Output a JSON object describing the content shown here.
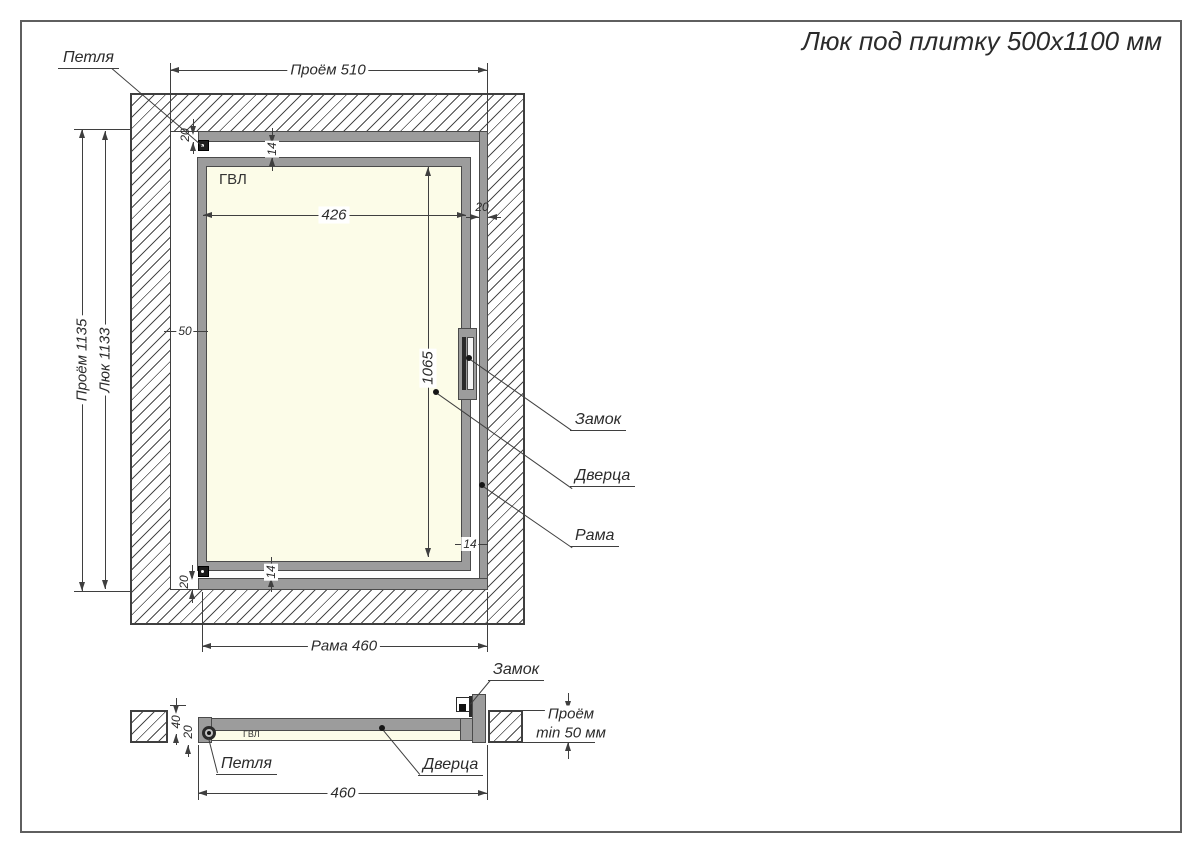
{
  "title": "Люк под плитку 500х1100 мм",
  "front_view": {
    "labels": {
      "hinge": "Петля",
      "lock": "Замок",
      "door": "Дверца",
      "frame": "Рама",
      "panel_material": "ГВЛ"
    },
    "dimensions": {
      "opening_width": "Проём 510",
      "opening_height": "Проём 1135",
      "hatch_height": "Люк 1133",
      "door_inner_width": "426",
      "door_inner_height": "1065",
      "side_offset": "50",
      "frame_top": "20",
      "gap_top": "14",
      "frame_right": "20",
      "gap_right": "14",
      "gap_bottom": "14",
      "frame_bottom": "20",
      "frame_width": "Рама 460"
    }
  },
  "section_view": {
    "labels": {
      "lock": "Замок",
      "hinge": "Петля",
      "door": "Дверца",
      "panel_material": "ГВЛ"
    },
    "dimensions": {
      "depth": "40",
      "panel": "20",
      "opening_note_line1": "Проём",
      "opening_note_line2": "min 50 мм",
      "frame_width": "460"
    }
  }
}
